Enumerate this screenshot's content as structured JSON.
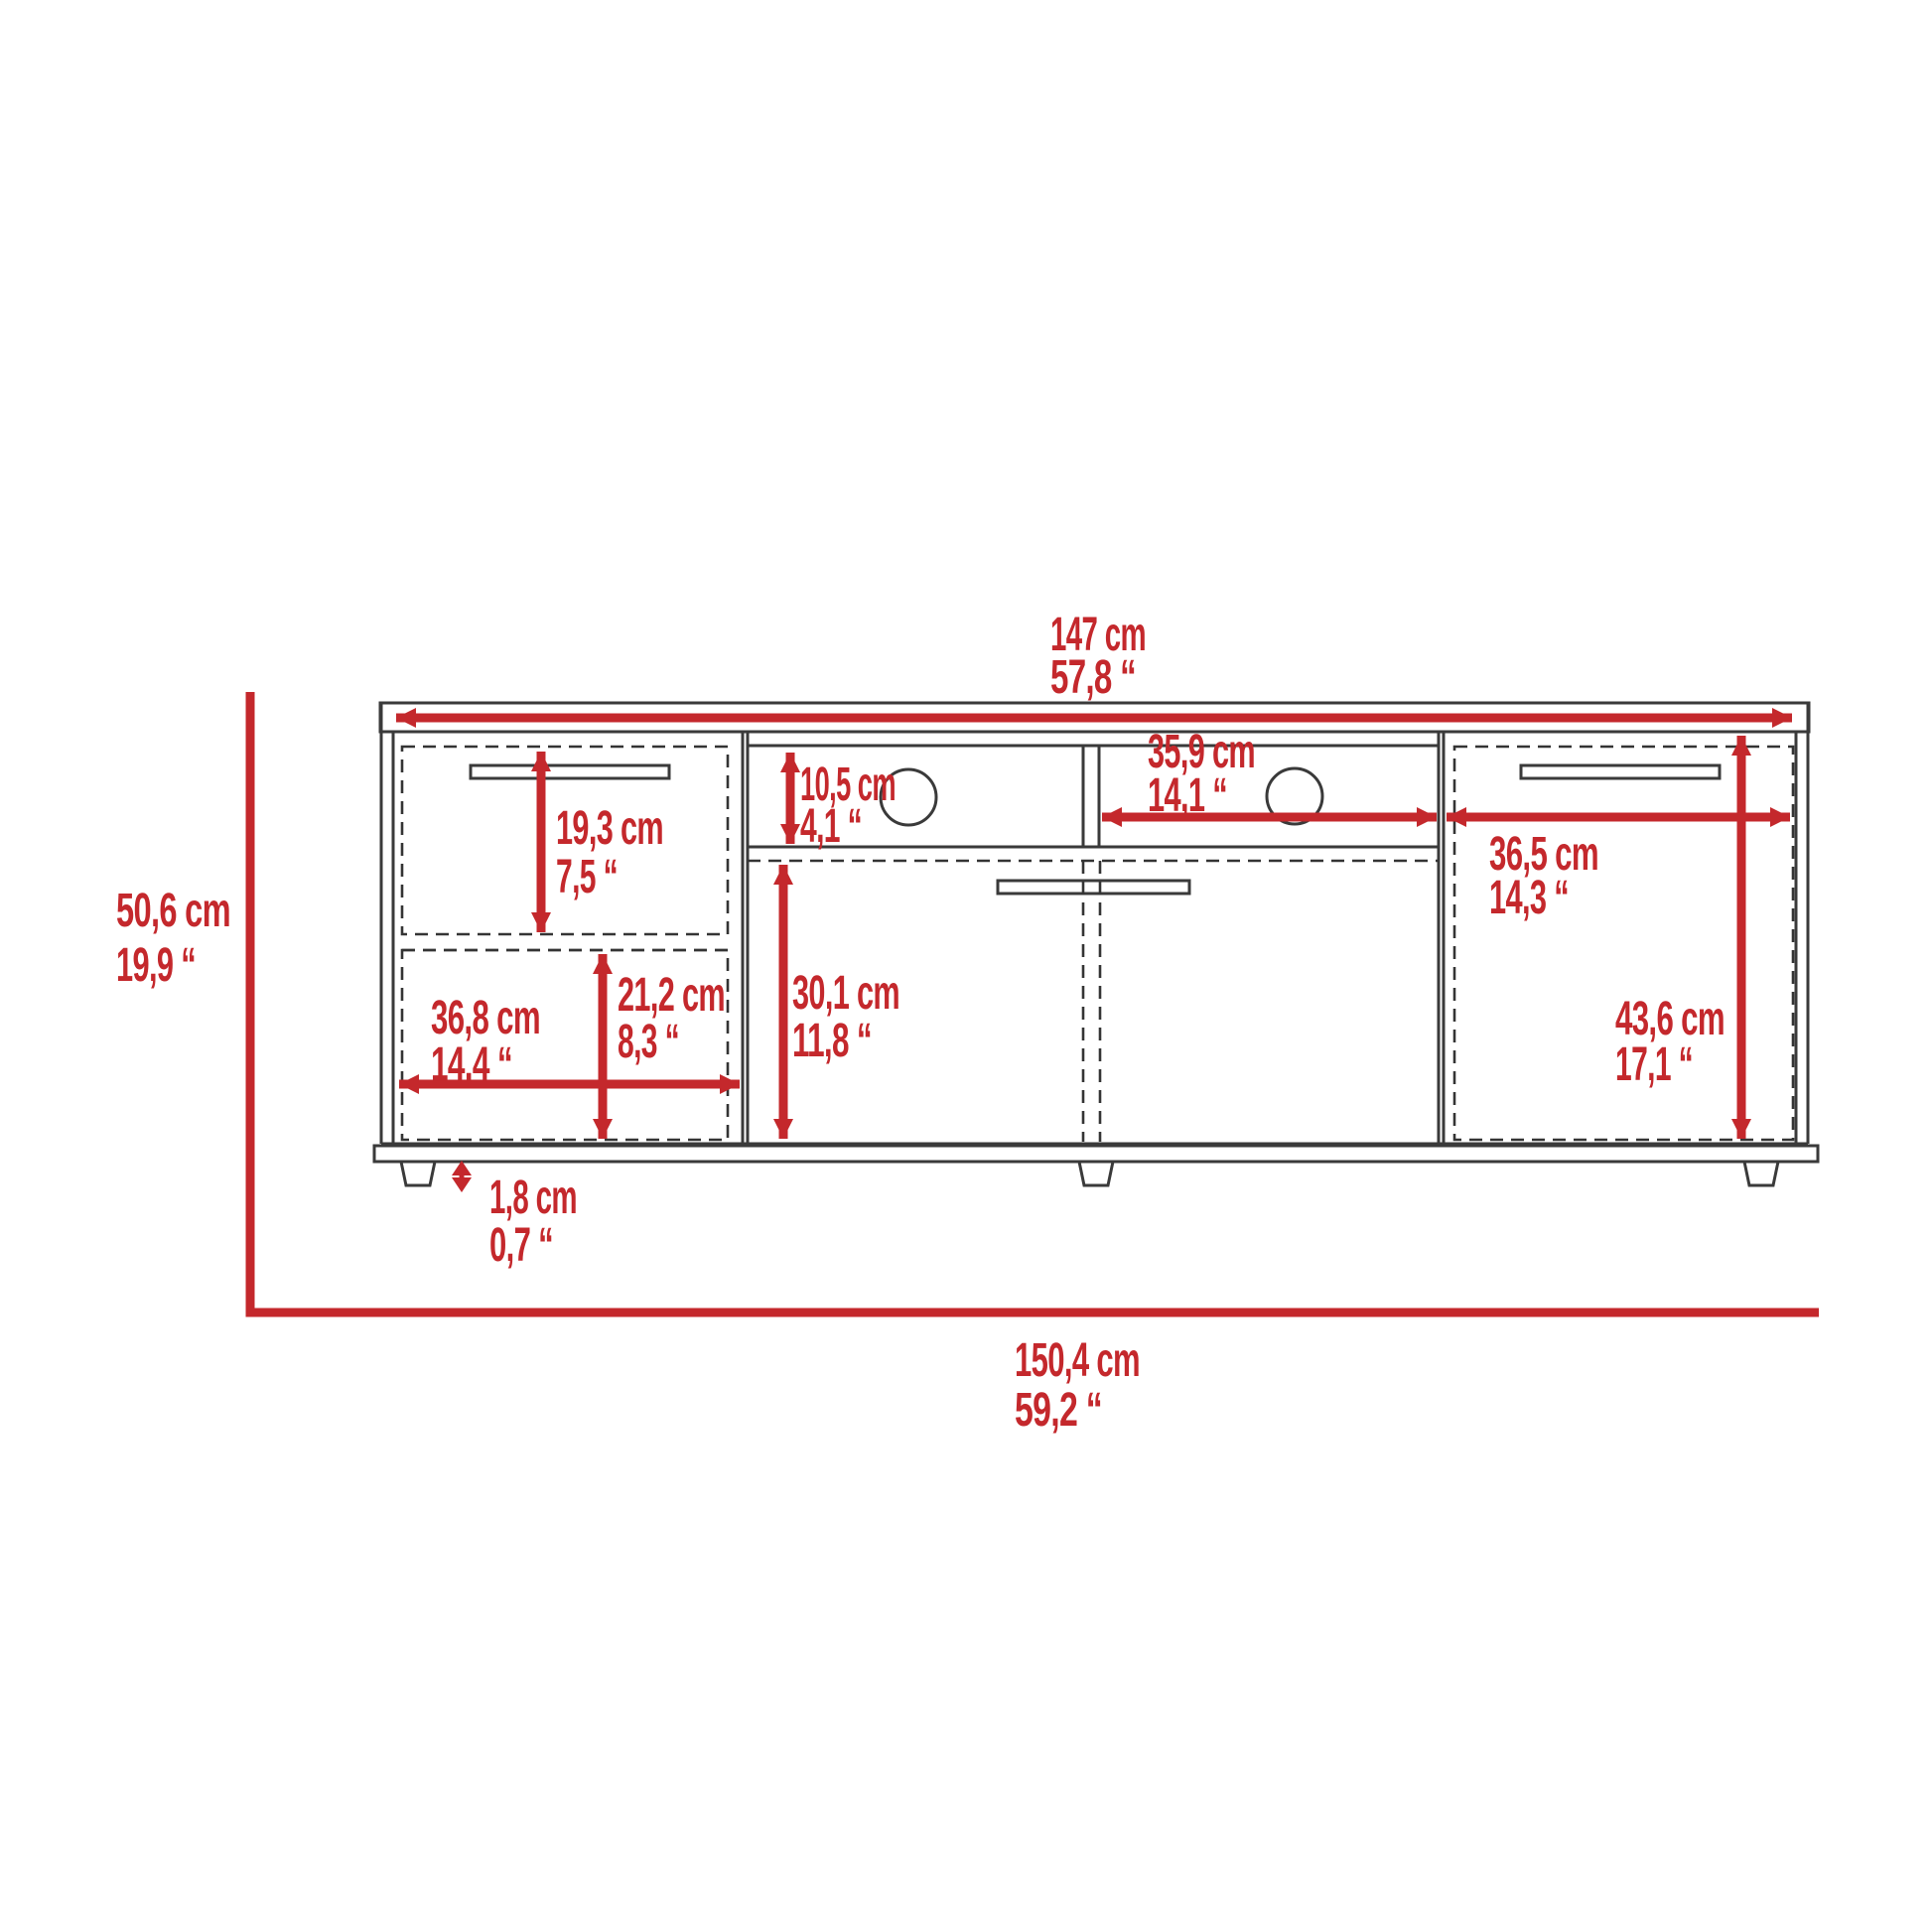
{
  "page": {
    "background": "#ffffff",
    "description": "Front elevation dimension drawing of a TV stand cabinet"
  },
  "colors": {
    "dimension_red": "#c4282c",
    "line_dark": "#3a3a3a"
  },
  "diagram": {
    "type": "furniture-dimension-drawing",
    "view": "front-elevation",
    "dimensions": {
      "overall_width": {
        "cm": "147 cm",
        "inches": "57,8 “"
      },
      "overall_height": {
        "cm": "50,6 cm",
        "inches": "19,9 “"
      },
      "base_total_width": {
        "cm": "150,4 cm",
        "inches": "59,2 “"
      },
      "left_door_height": {
        "cm": "19,3 cm",
        "inches": "7,5 “"
      },
      "left_section_width": {
        "cm": "36,8 cm",
        "inches": "14,4 “"
      },
      "left_opening_height": {
        "cm": "21,2 cm",
        "inches": "8,3 “"
      },
      "shelf_opening_height": {
        "cm": "10,5 cm",
        "inches": "4,1 “"
      },
      "shelf_opening_width": {
        "cm": "35,9 cm",
        "inches": "14,1 “"
      },
      "center_opening_height": {
        "cm": "30,1 cm",
        "inches": "11,8 “"
      },
      "right_section_width": {
        "cm": "36,5 cm",
        "inches": "14,3 “"
      },
      "right_door_height": {
        "cm": "43,6 cm",
        "inches": "17,1 “"
      },
      "foot_height": {
        "cm": "1,8 cm",
        "inches": "0,7 “"
      }
    }
  }
}
